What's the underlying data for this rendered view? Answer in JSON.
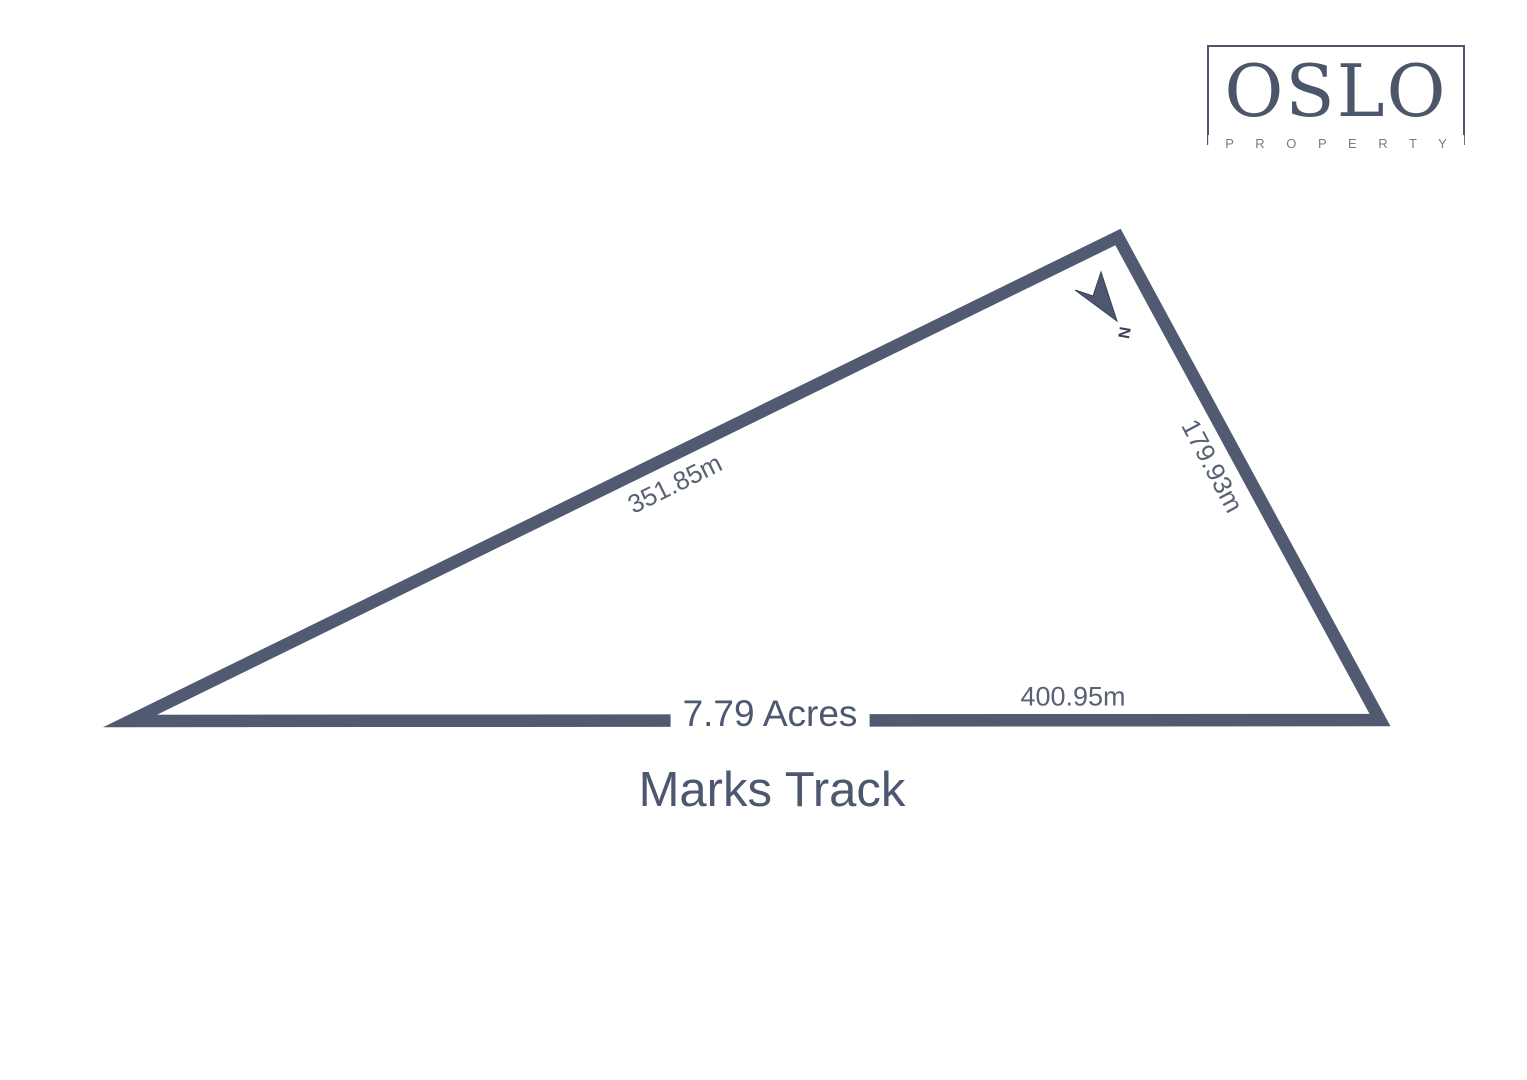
{
  "logo": {
    "name": "OSLO",
    "subtitle": "P R O P E R T Y"
  },
  "parcel": {
    "area_label": "7.79 Acres",
    "street_label": "Marks Track",
    "north_label": "N",
    "sides": [
      {
        "id": "northwest-boundary",
        "length_label": "351.85m"
      },
      {
        "id": "east-boundary",
        "length_label": "179.93m"
      },
      {
        "id": "south-boundary",
        "length_label": "400.95m"
      }
    ],
    "vertices": [
      {
        "x": 130,
        "y": 721
      },
      {
        "x": 1118,
        "y": 237
      },
      {
        "x": 1380,
        "y": 720
      }
    ]
  },
  "colors": {
    "outline": "#505b71",
    "dark_text": "#4d5870",
    "label_gray": "#596273",
    "logo": "#4c566b",
    "logo_subtitle": "#757b87",
    "background": "#ffffff"
  }
}
